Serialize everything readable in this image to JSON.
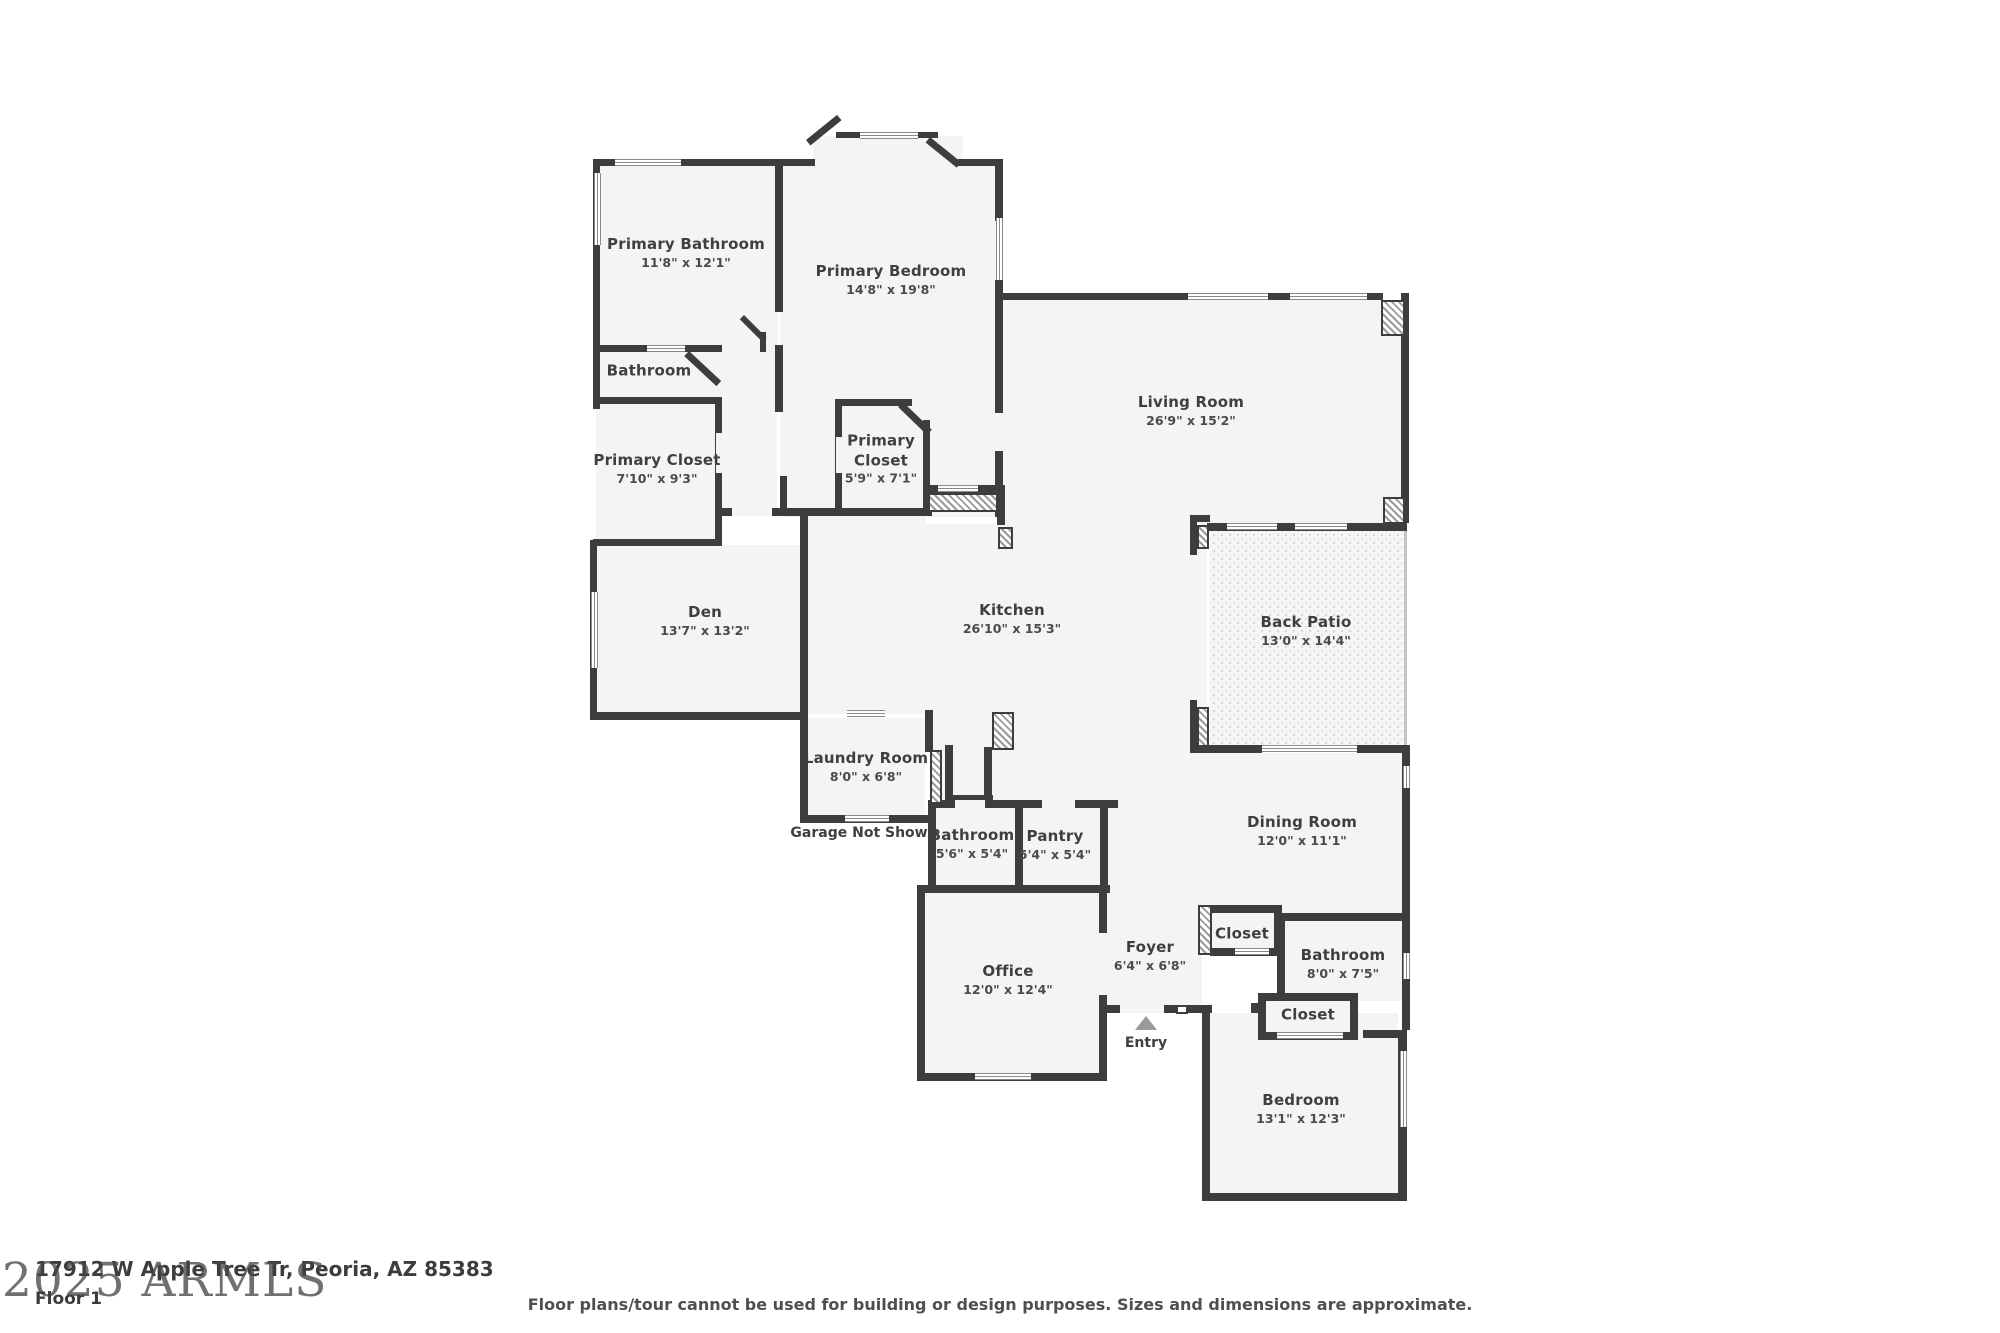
{
  "floor_plan": {
    "rooms": [
      {
        "name": "Primary Bathroom",
        "dims": "11'8\" x 12'1\""
      },
      {
        "name": "Primary Bedroom",
        "dims": "14'8\" x 19'8\""
      },
      {
        "name": "Bathroom",
        "dims": ""
      },
      {
        "name": "Primary Closet",
        "dims": "7'10\" x 9'3\""
      },
      {
        "name": "Primary Closet",
        "dims": "5'9\" x 7'1\""
      },
      {
        "name": "Living Room",
        "dims": "26'9\" x 15'2\""
      },
      {
        "name": "Den",
        "dims": "13'7\" x 13'2\""
      },
      {
        "name": "Kitchen",
        "dims": "26'10\" x 15'3\""
      },
      {
        "name": "Back Patio",
        "dims": "13'0\" x 14'4\""
      },
      {
        "name": "Laundry Room",
        "dims": "8'0\" x 6'8\""
      },
      {
        "name": "Bathroom",
        "dims": "5'6\" x 5'4\""
      },
      {
        "name": "Pantry",
        "dims": "5'4\" x 5'4\""
      },
      {
        "name": "Dining Room",
        "dims": "12'0\" x 11'1\""
      },
      {
        "name": "Office",
        "dims": "12'0\" x 12'4\""
      },
      {
        "name": "Foyer",
        "dims": "6'4\" x 6'8\""
      },
      {
        "name": "Closet",
        "dims": ""
      },
      {
        "name": "Bathroom",
        "dims": "8'0\" x 7'5\""
      },
      {
        "name": "Closet",
        "dims": ""
      },
      {
        "name": "Bedroom",
        "dims": "13'1\" x 12'3\""
      }
    ],
    "annotations": {
      "garage_note": "Garage Not Shown",
      "entry_label": "Entry"
    },
    "footer": {
      "watermark": "2025 ARMLS",
      "address": "17912 W Apple Tree Tr, Peoria, AZ 85383",
      "floor_label": "Floor 1",
      "disclaimer": "Floor plans/tour cannot be used for building or design purposes. Sizes and dimensions are approximate."
    },
    "colors": {
      "wall": "#3d3d3d",
      "room_fill": "#f4f4f4",
      "label_text": "#3f3f3f",
      "entry_arrow": "#9a9a9a"
    }
  }
}
